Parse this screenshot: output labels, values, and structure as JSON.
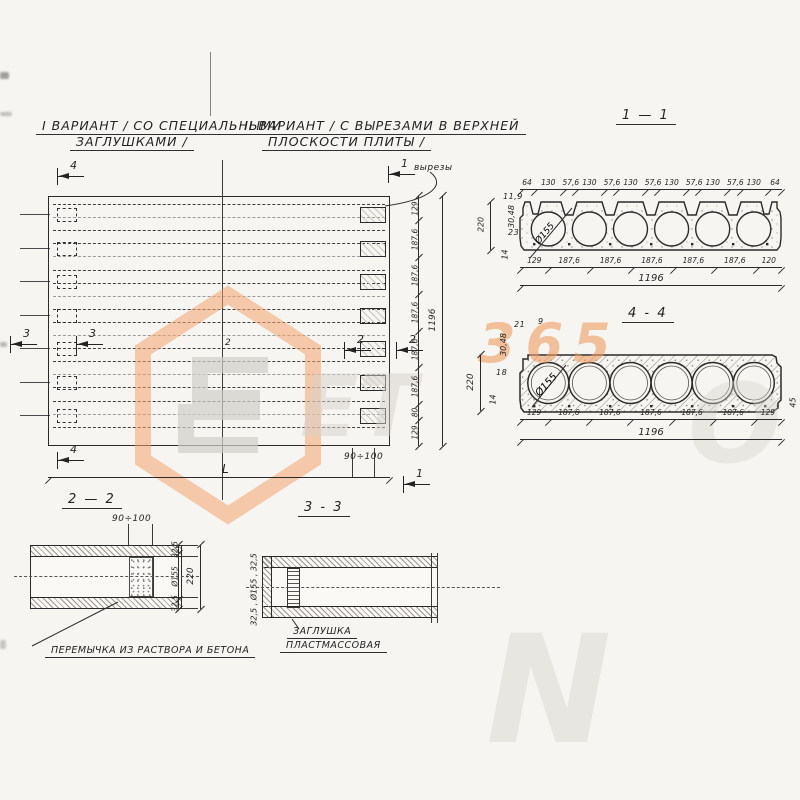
{
  "titles": {
    "variant1_line1": "I ВАРИАНТ / СО СПЕЦИАЛЬНЫМИ",
    "variant1_line2": "ЗАГЛУШКАМИ /",
    "variant2_line1": "II ВАРИАНТ / С ВЫРЕЗАМИ  В ВЕРХНЕЙ",
    "variant2_line2": "ПЛОСКОСТИ ПЛИТЫ /",
    "cutouts_label": "вырезы",
    "section_1_1": "1 — 1",
    "section_4_4": "4 - 4",
    "section_2_2": "2 — 2",
    "section_3_3": "3 - 3"
  },
  "plan": {
    "marker_4_top": "4",
    "marker_4_bottom": "4",
    "marker_3_left": "3",
    "marker_3_right": "3",
    "marker_2_left": "2",
    "marker_2_right": "2",
    "marker_2_center": "2",
    "marker_1_top": "1",
    "marker_1_bottom": "1",
    "dim_90_100": "90÷100",
    "dim_L": "L",
    "right_chain": [
      "129",
      "187,6",
      "187,6",
      "187,6",
      "187,6",
      "187,6",
      "80",
      "129"
    ],
    "right_total": "1196"
  },
  "section11": {
    "top_chain": [
      "64",
      "130",
      "57,6",
      "130",
      "57,6",
      "130",
      "57,6",
      "130",
      "57,6",
      "130",
      "57,6",
      "130",
      "64"
    ],
    "bottom_chain": [
      "129",
      "187,6",
      "187,6",
      "187,6",
      "187,6",
      "187,6",
      "120"
    ],
    "total": "1196",
    "height": "220",
    "d1": "11,9",
    "d2": "30,48",
    "d3": "23",
    "d4": "14",
    "dia": "Ø155"
  },
  "section44": {
    "top_a": "21",
    "top_b": "9",
    "left_a": "30,48",
    "left_b": "18",
    "left_c": "14",
    "height": "220",
    "right_d": "45",
    "bottom_chain": [
      "129",
      "187,6",
      "187,6",
      "187,6",
      "187,6",
      "187,6",
      "129"
    ],
    "total": "1196",
    "dia": "Ø155"
  },
  "section22": {
    "dim_top": "90÷100",
    "right_chain": [
      "32,5",
      "Ø155",
      "32,5"
    ],
    "total": "220",
    "note": "ПЕРЕМЫЧКА ИЗ РАСТВОРА И БЕТОНА"
  },
  "section33": {
    "side_label": "32,5 , Ø155 , 32,5",
    "note_line1": "ЗАГЛУШКА",
    "note_line2": "ПЛАСТМАССОВАЯ"
  },
  "watermark": {
    "t365": "365",
    "t_et": "ET",
    "t_o": "O",
    "t_n": "N",
    "orange": "#ef9c5f",
    "gray": "#d7d3cc"
  }
}
